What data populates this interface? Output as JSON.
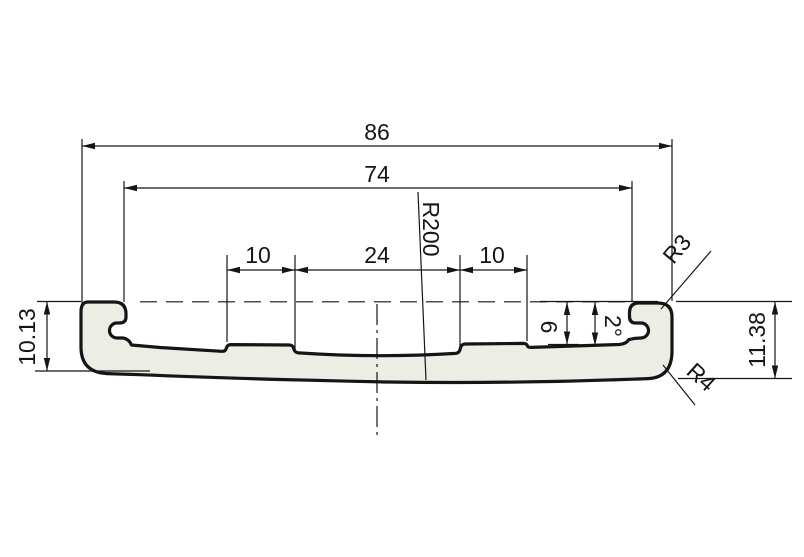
{
  "background": "#ffffff",
  "colors": {
    "profile_fill": "#ecede5",
    "line": "#151515"
  },
  "dims": {
    "overall_width": "86",
    "inner_width": "74",
    "left_step_width": "10",
    "center_width": "24",
    "right_step_width": "10",
    "surface_radius": "R200",
    "hook_corner_radius": "R3",
    "hook_bottom_radius": "R4",
    "left_height": "10.13",
    "right_height": "11.38",
    "step_height": "6",
    "surface_angle": "2°"
  }
}
